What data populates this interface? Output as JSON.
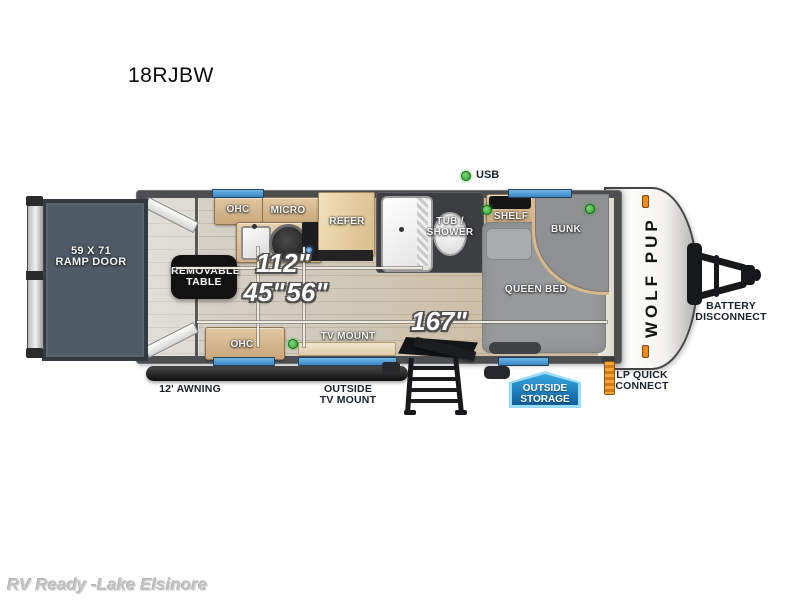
{
  "page": {
    "title": "18RJBW",
    "watermark": "RV Ready -Lake Elsinore"
  },
  "legend": {
    "usb": "USB"
  },
  "floorplan": {
    "model_logo": "WOLF PUP",
    "ramp_door": {
      "line1": "59 X 71",
      "line2": "RAMP DOOR"
    },
    "labels": {
      "ohc_top": "OHC",
      "micro": "MICRO",
      "refer": "REFER",
      "tub_shower_line1": "TUB /",
      "tub_shower_line2": "SHOWER",
      "shelf": "SHELF",
      "bunk": "BUNK",
      "queen_bed": "QUEEN BED",
      "ohc_bottom": "OHC",
      "tv_mount": "TV MOUNT",
      "removable_table_line1": "REMOVABLE",
      "removable_table_line2": "TABLE"
    },
    "dimensions": {
      "d112": "112\"",
      "d45": "45\"",
      "d56": "56\"",
      "d167": "167\""
    },
    "exterior": {
      "awning": "12' AWNING",
      "outside_tv_line1": "OUTSIDE",
      "outside_tv_line2": "TV MOUNT",
      "storage_line1": "OUTSIDE",
      "storage_line2": "STORAGE",
      "lp_line1": "LP QUICK",
      "lp_line2": "CONNECT",
      "battery_line1": "BATTERY",
      "battery_line2": "DISCONNECT"
    }
  },
  "colors": {
    "window_blue": "#4a9bd8",
    "usb_green": "#35a832",
    "storage_blue": "#1a74b4",
    "marker_orange": "#f08a1d"
  }
}
